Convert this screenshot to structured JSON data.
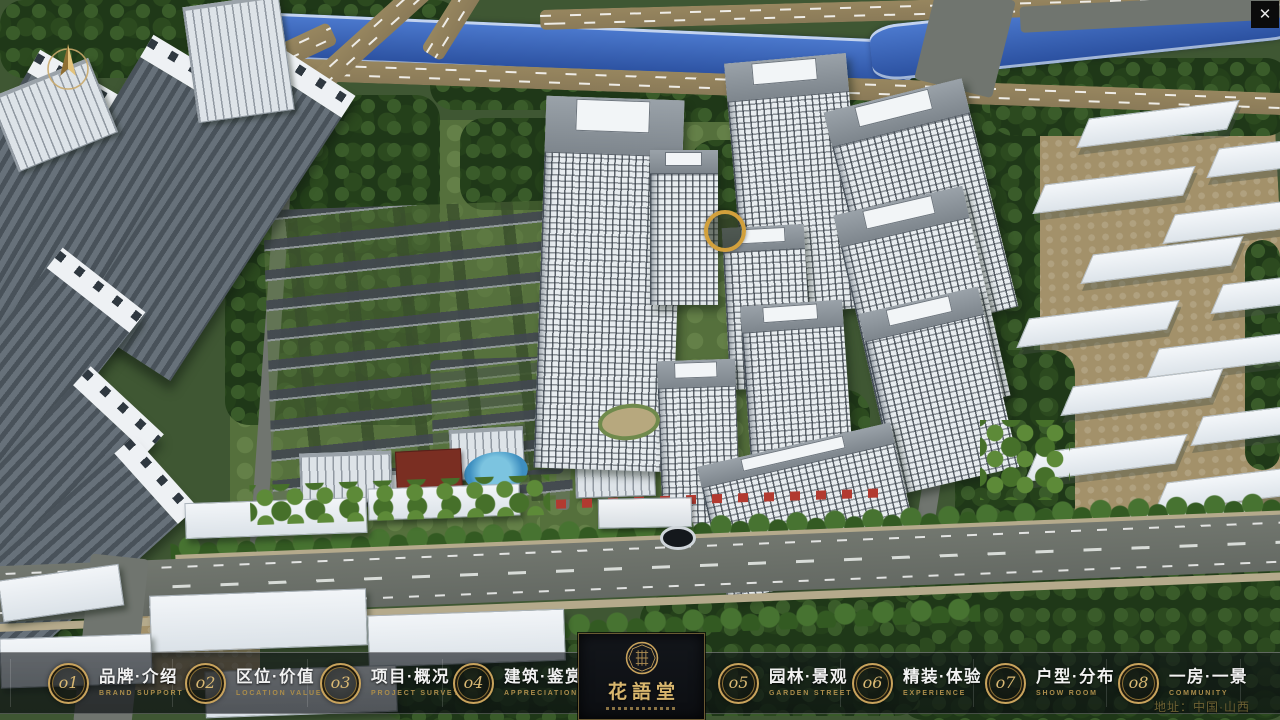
{
  "window": {
    "close_glyph": "✕"
  },
  "logo": {
    "title": "花語堂"
  },
  "menu": {
    "items": [
      {
        "num": "o1",
        "label": "品牌·介绍",
        "sub": "BRAND SUPPORT"
      },
      {
        "num": "o2",
        "label": "区位·价值",
        "sub": "LOCATION VALUE"
      },
      {
        "num": "o3",
        "label": "项目·概况",
        "sub": "PROJECT SURVEY"
      },
      {
        "num": "o4",
        "label": "建筑·鉴赏",
        "sub": "APPRECIATION"
      },
      {
        "num": "o5",
        "label": "园林·景观",
        "sub": "GARDEN STREET"
      },
      {
        "num": "o6",
        "label": "精装·体验",
        "sub": "EXPERIENCE"
      },
      {
        "num": "o7",
        "label": "户型·分布",
        "sub": "SHOW ROOM"
      },
      {
        "num": "o8",
        "label": "一房·一景",
        "sub": "COMMUNITY"
      }
    ]
  },
  "footer": {
    "address": "地址：中国·山西"
  },
  "colors": {
    "accent_gold": "#C9A35C",
    "badge_number_gold": "#D9B873",
    "menu_label_white": "#F2F2F2",
    "menu_sublabel_gold": "#AB8D4B",
    "logo_title_gold": "#D8B66E",
    "address_gold": "#6E6233",
    "river_blue": "#2E55A6",
    "bar_background": "#0A0E12"
  }
}
